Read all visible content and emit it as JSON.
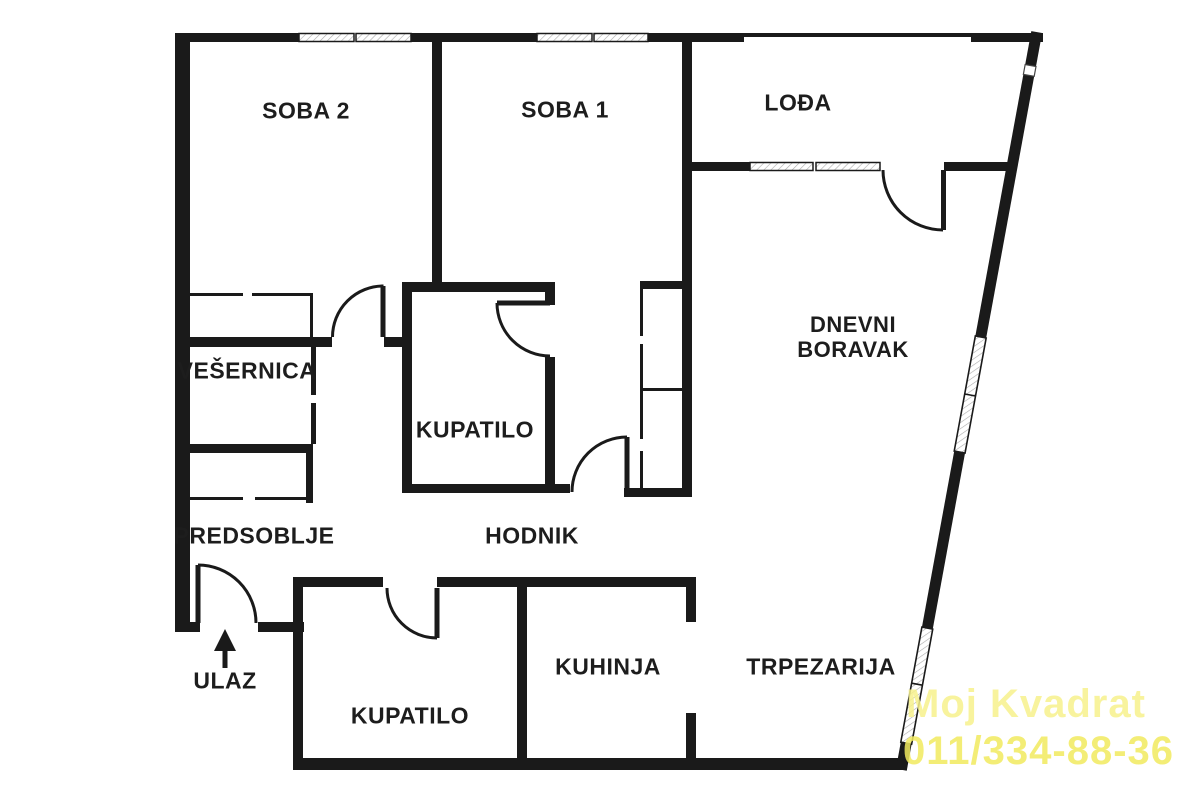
{
  "page": {
    "background": "#ffffff",
    "wall_color": "#1a1a1a",
    "text_color": "#1d1d1d"
  },
  "rooms": {
    "soba2": "SOBA 2",
    "soba1": "SOBA 1",
    "lodja": "LOĐA",
    "dnevni_line1": "DNEVNI",
    "dnevni_line2": "BORAVAK",
    "vesernica": "VEŠERNICA",
    "kupatilo_upper": "KUPATILO",
    "hodnik": "HODNIK",
    "predsoblje": "PREDSOBLJE",
    "kupatilo_lower": "KUPATILO",
    "kuhinja": "KUHINJA",
    "trpezarija": "TRPEZARIJA"
  },
  "entrance": {
    "label": "ULAZ"
  },
  "watermark": {
    "line1": "Moj Kvadrat",
    "line2": "011/334-88-36",
    "color_line1": "#f7f28c",
    "color_line2": "#f2ea5f"
  }
}
